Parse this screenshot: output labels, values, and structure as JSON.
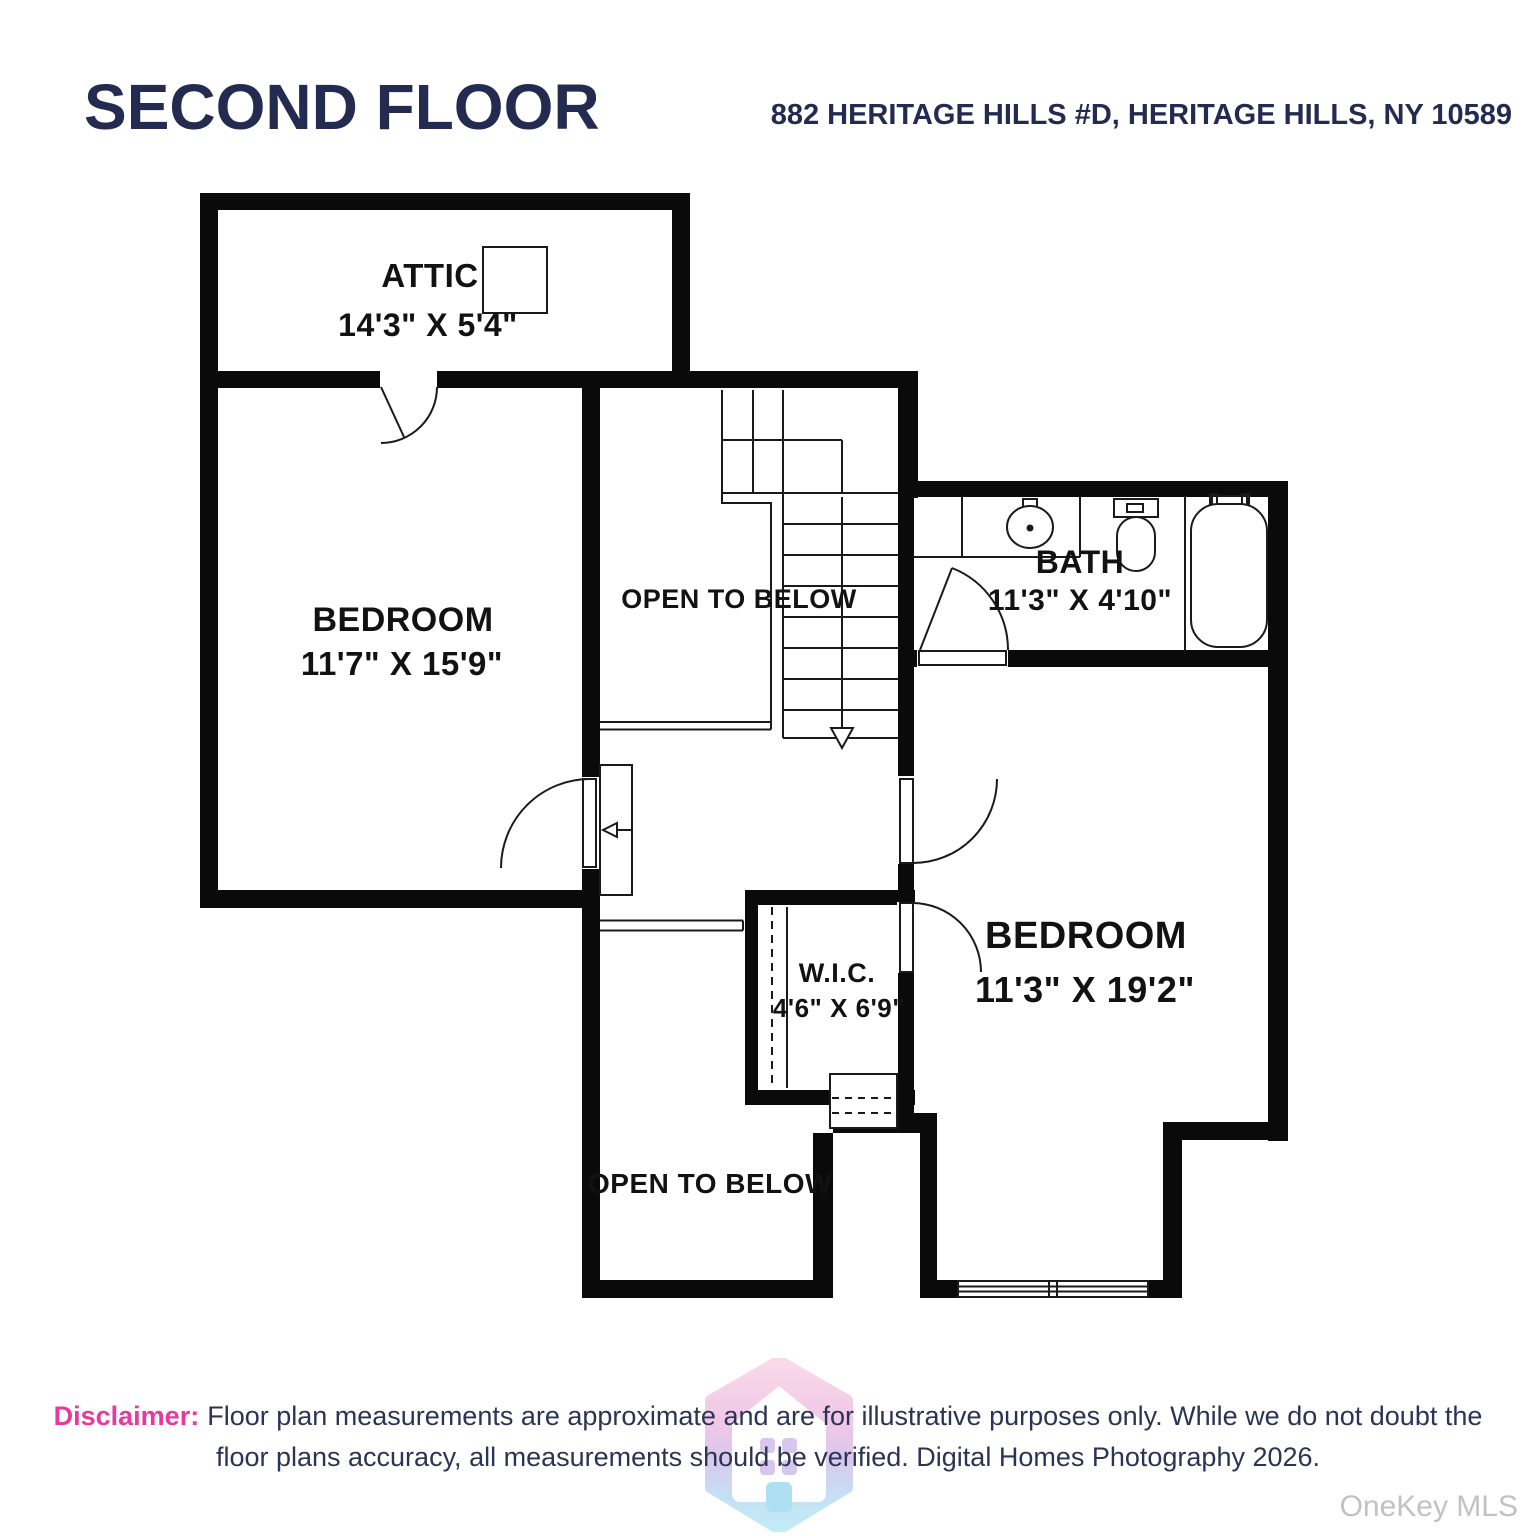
{
  "header": {
    "title": "SECOND FLOOR",
    "address": "882 HERITAGE HILLS #D, HERITAGE HILLS, NY 10589",
    "text_color": "#232c50"
  },
  "plan": {
    "wall_color": "#0a0a0a",
    "rooms": {
      "attic": {
        "name": "ATTIC",
        "dims": "14'3\" X 5'4\""
      },
      "bedroom_left": {
        "name": "BEDROOM",
        "dims": "11'7\" X 15'9\""
      },
      "open_to_below_center": {
        "name": "OPEN TO BELOW"
      },
      "bath": {
        "name": "BATH",
        "dims": "11'3\" X 4'10\""
      },
      "bedroom_right": {
        "name": "BEDROOM",
        "dims": "11'3\" X 19'2\""
      },
      "wic": {
        "name": "W.I.C.",
        "dims": "4'6\" X 6'9\""
      },
      "open_to_below_bottom": {
        "name": "OPEN TO BELOW"
      }
    }
  },
  "disclaimer": {
    "label": "Disclaimer:",
    "label_color": "#e83a9c",
    "line1": "Floor plan measurements are approximate and are for illustrative purposes only. While we do not doubt the",
    "line2": "floor plans accuracy, all measurements should be verified. Digital Homes Photography 2026."
  },
  "watermarks": {
    "mls": "OneKey MLS",
    "logo": "digital-homes-hexagon-house-logo"
  }
}
